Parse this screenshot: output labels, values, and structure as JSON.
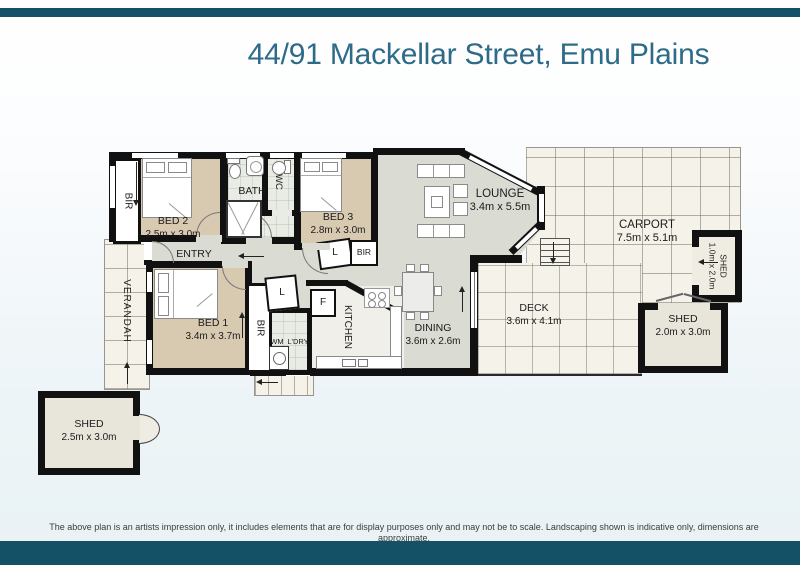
{
  "header": {
    "title": "44/91 Mackellar Street, Emu Plains"
  },
  "colors": {
    "accent_bar": "#145066",
    "title_text": "#2d6b89",
    "wall": "#111111",
    "bedroom_floor": "#d8c9b1",
    "living_floor": "#dadbd2",
    "tile_floor": "#e8ece4",
    "outdoor_floor": "#f5f2e9",
    "shed_floor": "#e8e5da",
    "background": "#edf4f7"
  },
  "rooms": {
    "bed1": {
      "name": "BED 1",
      "dims": "3.4m x 3.7m"
    },
    "bed2": {
      "name": "BED 2",
      "dims": "2.5m x 3.0m"
    },
    "bed3": {
      "name": "BED 3",
      "dims": "2.8m x 3.0m"
    },
    "bath": {
      "name": "BATH"
    },
    "wc": {
      "name": "WC"
    },
    "entry": {
      "name": "ENTRY"
    },
    "verandah": {
      "name": "VERANDAH"
    },
    "lounge": {
      "name": "LOUNGE",
      "dims": "3.4m x 5.5m"
    },
    "dining": {
      "name": "DINING",
      "dims": "3.6m x 2.6m"
    },
    "kitchen": {
      "name": "KITCHEN"
    },
    "laundry": {
      "name": "L'DRY"
    },
    "wm": {
      "name": "WM"
    },
    "fridge": {
      "name": "F"
    },
    "linen": {
      "name": "L"
    },
    "bir": {
      "name": "BIR"
    },
    "deck": {
      "name": "DECK",
      "dims": "3.6m x 4.1m"
    },
    "carport": {
      "name": "CARPORT",
      "dims": "7.5m x 5.1m"
    },
    "shed_small": {
      "name": "SHED",
      "dims": "1.0m x 2.0m"
    },
    "shed_right": {
      "name": "SHED",
      "dims": "2.0m x 3.0m"
    },
    "shed_left": {
      "name": "SHED",
      "dims": "2.5m x 3.0m"
    }
  },
  "footer": {
    "disclaimer": "The above plan is an artists impression only, it includes elements that are for display purposes only and may not be to scale. Landscaping shown is indicative only, dimensions are approximate."
  }
}
